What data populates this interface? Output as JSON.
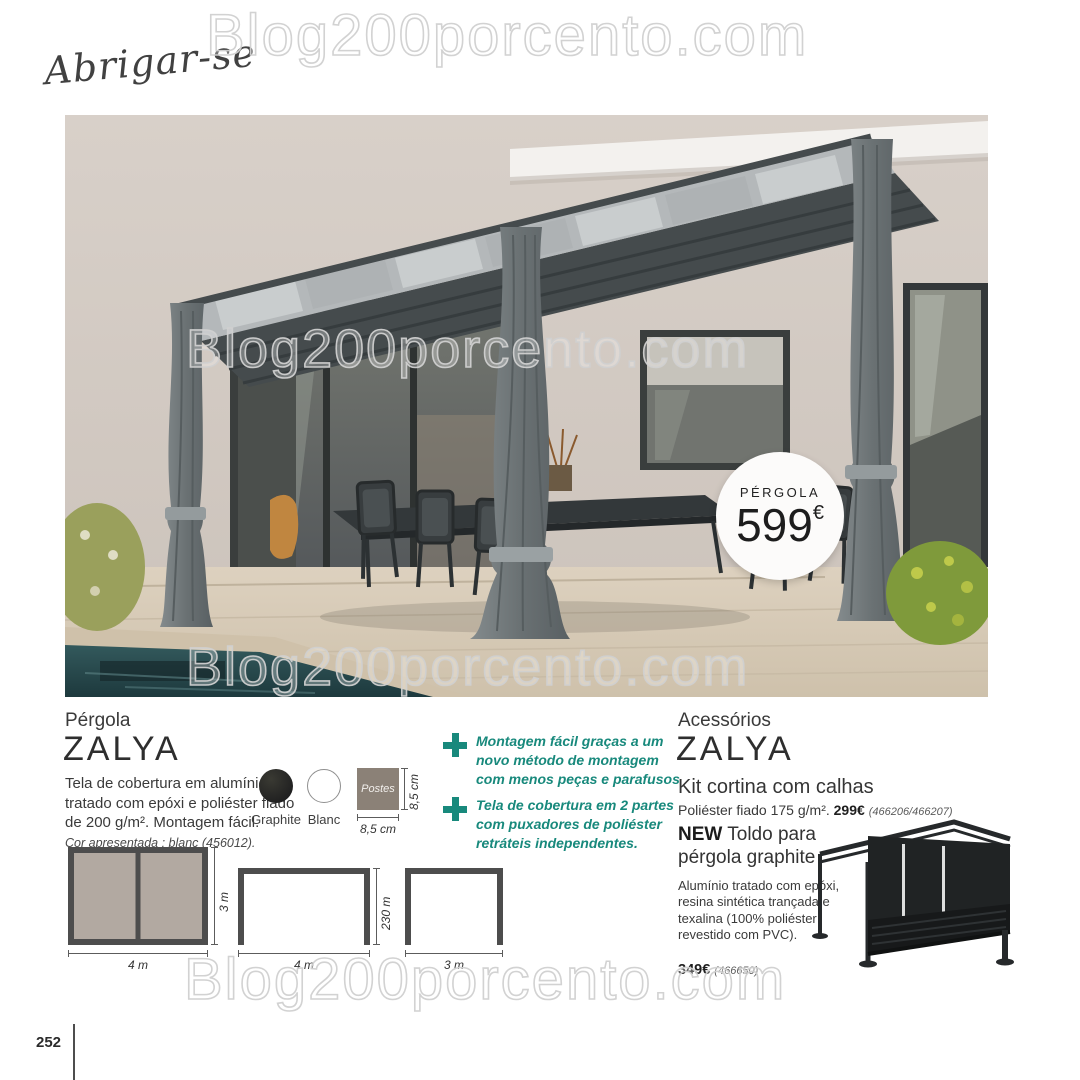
{
  "page": {
    "section_label": "Abrigar-se",
    "watermark": "Blog200porcento.com",
    "page_number": "252"
  },
  "badge": {
    "label": "PÉRGOLA",
    "price": "599",
    "currency": "€"
  },
  "product": {
    "category": "Pérgola",
    "name": "ZALYA",
    "description": "Tela de cobertura em alumínio tratado com epóxi e poliéster fiado de 200 g/m². Montagem fácil.",
    "color_note": "Cor apresentada : blanc (456012).",
    "swatches": [
      {
        "name": "Graphite",
        "hex": "#23241f"
      },
      {
        "name": "Blanc",
        "hex": "#ffffff"
      }
    ],
    "post_swatch": {
      "label": "Postes",
      "width_label": "8,5 cm",
      "height_label": "8,5 cm",
      "hex": "#8b8177"
    },
    "drawings": [
      {
        "width_label": "4 m",
        "height_label": "3 m"
      },
      {
        "width_label": "4 m",
        "height_label": "230 m"
      },
      {
        "width_label": "3 m",
        "height_label": ""
      }
    ]
  },
  "features": [
    {
      "text": "Montagem fácil graças a um novo método de montagem com menos peças e parafusos"
    },
    {
      "text": "Tela de cobertura em 2 partes com puxadores de poliéster retráteis independentes."
    }
  ],
  "accessories": {
    "category": "Acessórios",
    "name": "ZALYA",
    "kit": {
      "title": "Kit cortina com calhas",
      "desc": "Poliéster fiado 175 g/m².",
      "price": "299€",
      "refs": "(466206/466207)"
    },
    "toldo": {
      "badge": "NEW",
      "title": "Toldo para pérgola graphite",
      "desc": "Alumínio tratado com epóxi, resina sintética trançada e texalina (100% poliéster revestido com PVC).",
      "price": "349€",
      "refs": "(466650)"
    }
  },
  "colors": {
    "accent": "#18897c",
    "pool": "#2e5457",
    "wall": "#d3cac2",
    "frame": "#4a5052"
  }
}
